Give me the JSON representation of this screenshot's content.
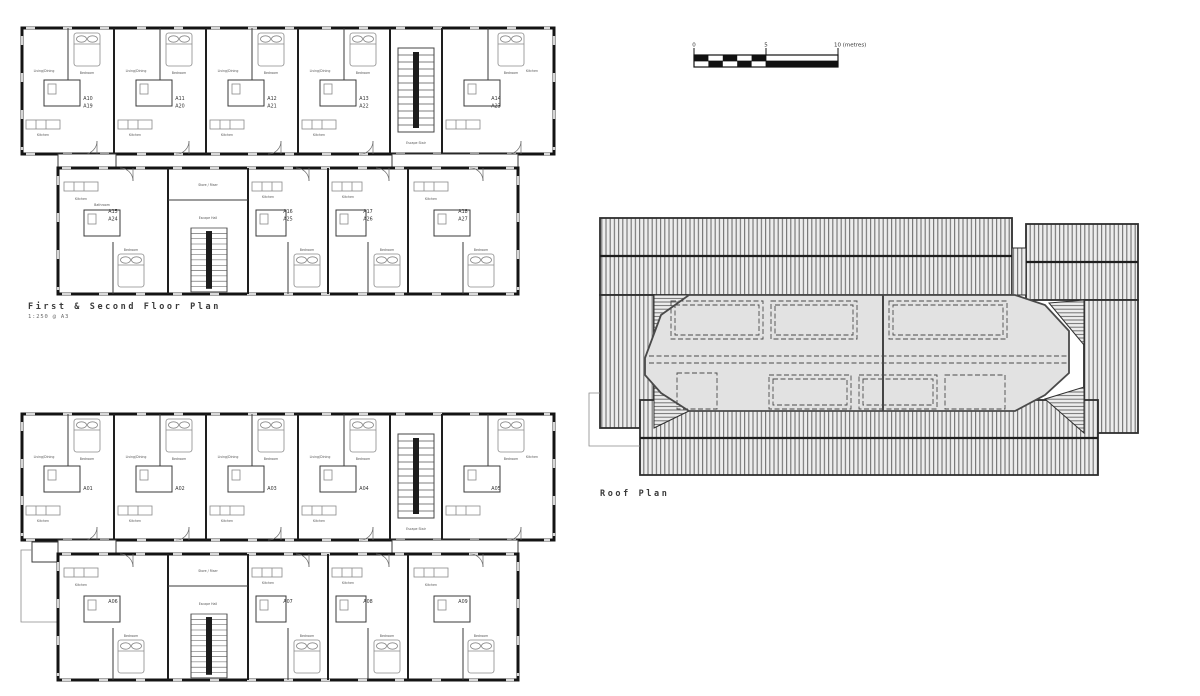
{
  "titles": {
    "first_second_floor_plan": "First & Second Floor Plan",
    "first_second_scale_note": "1:250 @ A3",
    "roof_plan": "Roof Plan"
  },
  "scale_bar": {
    "zero": "0",
    "five": "5",
    "ten": "10 (metres)"
  },
  "plan_first_second": {
    "upper_units": [
      {
        "first": "A10",
        "second": "A19"
      },
      {
        "first": "A11",
        "second": "A20"
      },
      {
        "first": "A12",
        "second": "A21"
      },
      {
        "first": "A13",
        "second": "A22"
      },
      {
        "first": "A14",
        "second": "A23"
      }
    ],
    "lower_units": [
      {
        "first": "A15",
        "second": "A24"
      },
      {
        "first": "A16",
        "second": "A25"
      },
      {
        "first": "A17",
        "second": "A26"
      },
      {
        "first": "A18",
        "second": "A27"
      }
    ]
  },
  "plan_ground": {
    "upper_units": [
      "A01",
      "A02",
      "A03",
      "A04",
      "A05"
    ],
    "lower_units": [
      "A06",
      "A07",
      "A08",
      "A09"
    ]
  },
  "rooms": {
    "kitchen": "Kitchen",
    "bedroom": "Bedroom",
    "bathroom": "Bathroom",
    "living_dining": "Living/Dining",
    "store_riser": "Store / Riser",
    "escape_hall": "Escape Hall",
    "escape_stair": "Escape Stair"
  },
  "colors": {
    "wall": "#141414",
    "roof_hatch": "#707070",
    "flat_roof": "#e2e2e2",
    "paper": "#ffffff"
  }
}
